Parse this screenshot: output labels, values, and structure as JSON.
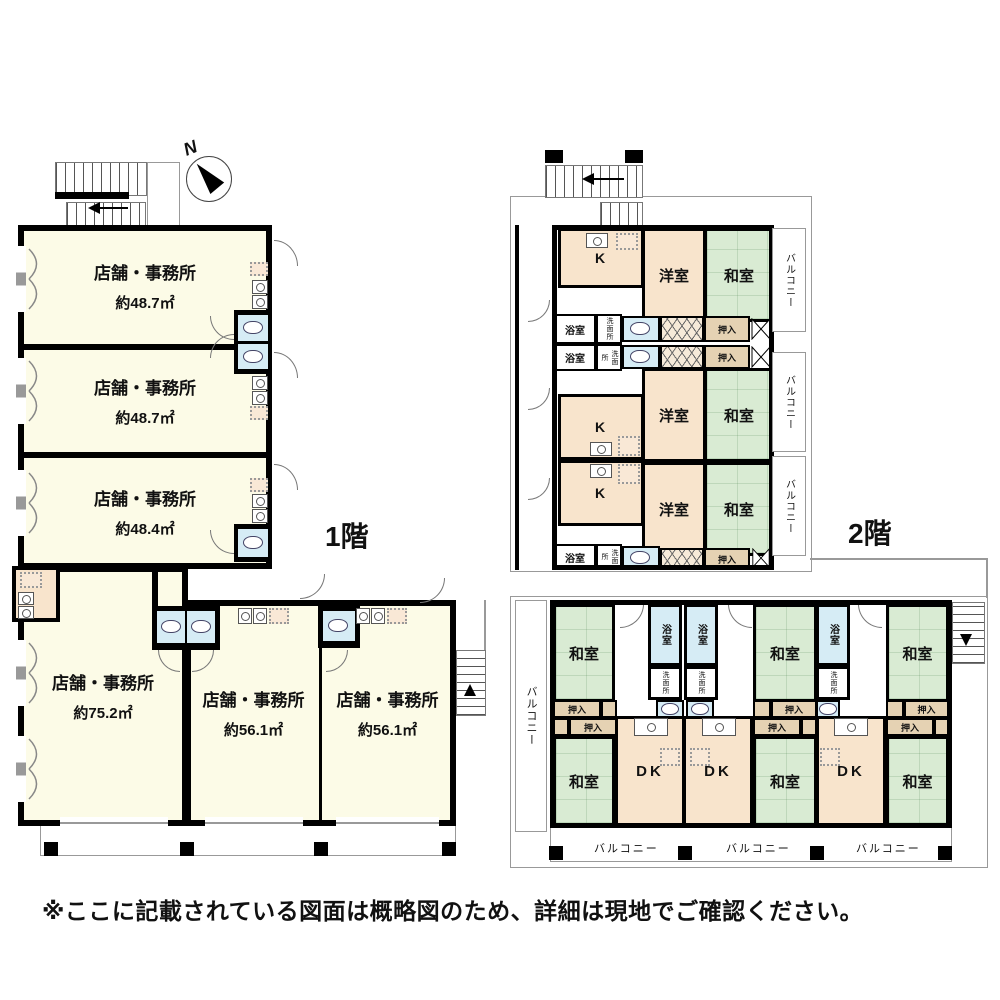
{
  "compass": {
    "label": "N"
  },
  "floor1": {
    "label": "1階",
    "rooms": [
      {
        "name": "店舗・事務所",
        "area": "約48.7㎡"
      },
      {
        "name": "店舗・事務所",
        "area": "約48.7㎡"
      },
      {
        "name": "店舗・事務所",
        "area": "約48.4㎡"
      },
      {
        "name": "店舗・事務所",
        "area": "約75.2㎡"
      },
      {
        "name": "店舗・事務所",
        "area": "約56.1㎡"
      },
      {
        "name": "店舗・事務所",
        "area": "約56.1㎡"
      }
    ]
  },
  "floor2": {
    "label": "2階",
    "labels": {
      "kitchen": "K",
      "western": "洋室",
      "japanese": "和室",
      "bath": "浴室",
      "wash": "洗面所",
      "closet": "押入",
      "balcony": "バルコニー",
      "dk": "DK"
    }
  },
  "footer": {
    "note": "※ここに記載されている図面は概略図のため、詳細は現地でご確認ください。"
  },
  "colors": {
    "wall": "#000000",
    "shop_room": "#fcfbe7",
    "western_room": "#f8e4cc",
    "tatami_room": "#d9ebd3",
    "water_area": "#d6ecf5",
    "closet": "#e5d2b3",
    "outline": "#999999"
  }
}
